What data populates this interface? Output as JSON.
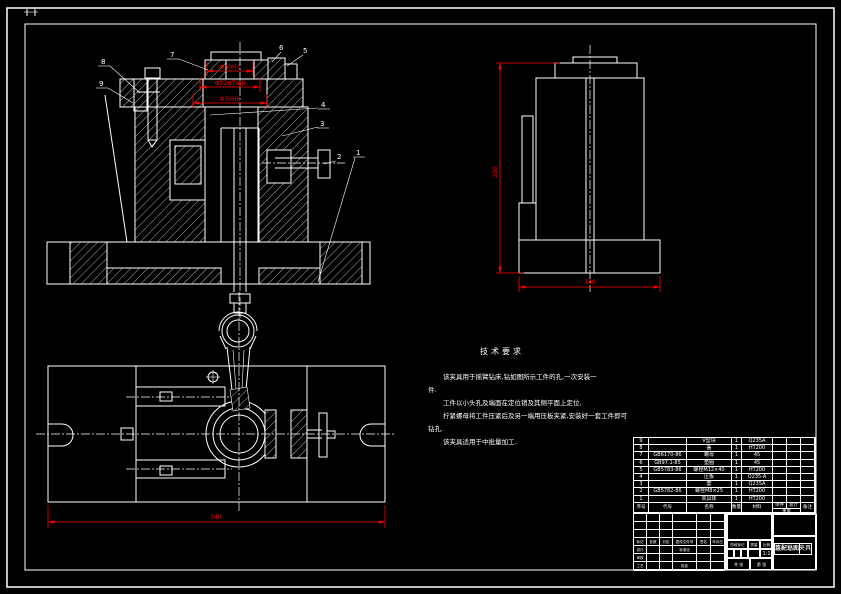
{
  "page": {
    "background": "#000000",
    "line_color": "#ffffff",
    "dimension_color": "#ff0000"
  },
  "front_view": {
    "dims": {
      "d1": "Φ40H7",
      "d2": "Φ52H7/g6",
      "d3": "Φ70H6"
    },
    "balloons": [
      "1",
      "2",
      "3",
      "4",
      "5",
      "6",
      "7",
      "8",
      "9"
    ]
  },
  "side_view": {
    "height_dim": "230",
    "width_dim": "140"
  },
  "plan_view": {
    "width_dim": "340"
  },
  "tech_requirements": {
    "title": "技术要求",
    "lines": [
      "该夹具用于摇臂钻床,钻如图所示工件的孔,一次安装一",
      "件.",
      "工件以小头孔及端面在定位销及其侧平面上定位,",
      "拧紧螺母将工件压紧后及另一端用压板夹紧,安装好一套工件即可",
      "钻孔.",
      "该夹具适用于中批量加工."
    ]
  },
  "bom": {
    "headers": {
      "no": "序号",
      "code": "代号",
      "name": "名称",
      "qty": "数量",
      "material": "材料",
      "single": "单件",
      "total": "总计",
      "weight": "重量",
      "remark": "备注"
    },
    "rows": [
      {
        "no": "9",
        "code": "",
        "name": "V型块",
        "qty": "1",
        "material": "Q235A",
        "single": "",
        "total": "",
        "remark": ""
      },
      {
        "no": "8",
        "code": "",
        "name": "盖",
        "qty": "1",
        "material": "HT200",
        "single": "",
        "total": "",
        "remark": ""
      },
      {
        "no": "7",
        "code": "GB6170-86",
        "name": "螺母",
        "qty": "1",
        "material": "45",
        "single": "",
        "total": "",
        "remark": ""
      },
      {
        "no": "6",
        "code": "GB97.1-85",
        "name": "垫圈",
        "qty": "1",
        "material": "45",
        "single": "",
        "total": "",
        "remark": ""
      },
      {
        "no": "5",
        "code": "GB5783-86",
        "name": "螺栓M12×40",
        "qty": "1",
        "material": "HT200",
        "single": "",
        "total": "",
        "remark": ""
      },
      {
        "no": "4",
        "code": "",
        "name": "压板",
        "qty": "1",
        "material": "Q235-A",
        "single": "",
        "total": "",
        "remark": ""
      },
      {
        "no": "3",
        "code": "",
        "name": "套",
        "qty": "1",
        "material": "Q235A",
        "single": "",
        "total": "",
        "remark": ""
      },
      {
        "no": "2",
        "code": "GB5782-86",
        "name": "螺栓M8×25",
        "qty": "1",
        "material": "HT200",
        "single": "",
        "total": "",
        "remark": ""
      },
      {
        "no": "1",
        "code": "",
        "name": "夹具体",
        "qty": "1",
        "material": "HT200",
        "single": "",
        "total": "",
        "remark": ""
      }
    ]
  },
  "title_block": {
    "labels": {
      "mark": "标记",
      "count": "处数",
      "zone": "分区",
      "change_no": "更改文件号",
      "sign": "签名",
      "date": "年月日",
      "design": "设计",
      "standardize": "标准化",
      "check": "审核",
      "process": "工艺",
      "approve": "批准",
      "stage_mark": "阶段标记",
      "mass": "质量",
      "scale": "比例",
      "sheets": "共 张",
      "sheet_no": "第 张"
    },
    "scale_value": "1:1",
    "title_line1": "连杆钻孔夹具",
    "title_line2": "装配总图"
  }
}
